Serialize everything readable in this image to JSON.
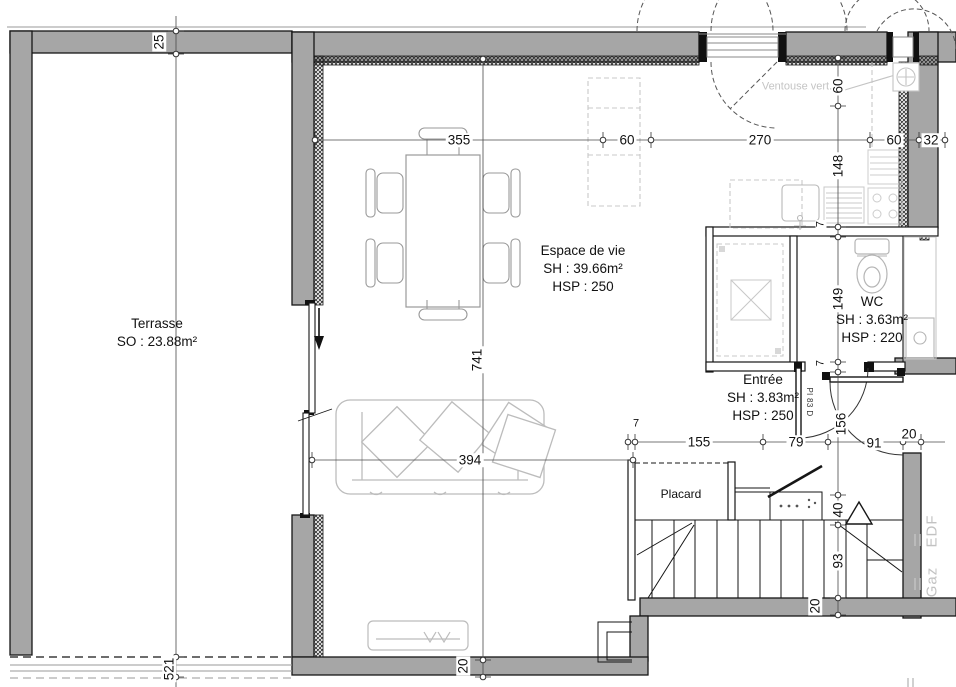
{
  "plan": {
    "rooms": {
      "terrasse": {
        "name": "Terrasse",
        "area": "SO : 23.88m²"
      },
      "living": {
        "name": "Espace de vie",
        "area": "SH : 39.66m²",
        "height": "HSP : 250"
      },
      "wc": {
        "name": "WC",
        "area": "SH : 3.63m²",
        "height": "HSP : 220"
      },
      "entree": {
        "name": "Entrée",
        "area": "SH : 3.83m²",
        "height": "HSP : 250"
      },
      "placard": {
        "name": "Placard"
      }
    },
    "dims": {
      "top_row": [
        "355",
        "60",
        "270",
        "60",
        "32"
      ],
      "right_col": [
        "60",
        "148",
        "149",
        "156",
        "40",
        "93",
        "20"
      ],
      "hall_row": [
        "7",
        "155",
        "79",
        "91",
        "20"
      ],
      "living_depth": "741",
      "sofa_line": "394",
      "terrace_wall": "25",
      "terrace_length": "521",
      "bottom_wall": "20",
      "partition_a": "7",
      "partition_b": "7"
    },
    "annotations": {
      "flue_note": "Ventouse vert.",
      "entry_door_tag": "Pl 83 D",
      "utility_gas": "Gaz",
      "utility_electric": "EDF"
    },
    "colors": {
      "wall": "#a6a6a6",
      "line": "#161616",
      "furniture_light": "#c8c8c8"
    }
  }
}
